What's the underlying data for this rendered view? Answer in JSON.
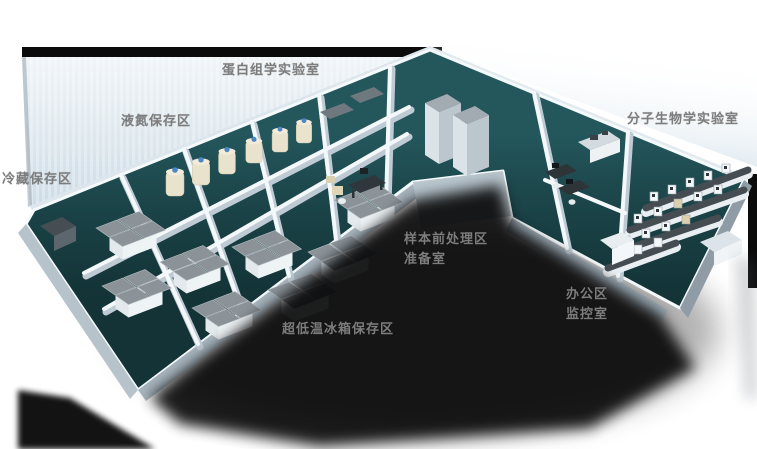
{
  "scene": {
    "kind": "3d-laboratory-floorplan-rendering",
    "colors": {
      "label_color": "#7d7d7d",
      "floor_teal": "#1d4e53",
      "cap_black": "#0b0b0b",
      "wall_white": "#f4f8fa",
      "backdrop_blue": "#d8e3eb",
      "tank_cream": "#e9e2cc",
      "tank_blue": "#4a86c8",
      "freezer_grey": "#8b9399",
      "shadow_black": "#000000"
    },
    "room_labels": [
      {
        "id": "cold-storage",
        "text": "冷藏保存区",
        "x": 2,
        "y": 168
      },
      {
        "id": "liquid-nitrogen",
        "text": "液氮保存区",
        "x": 121,
        "y": 110
      },
      {
        "id": "proteomics-lab",
        "text": "蛋白组学实验室",
        "x": 222,
        "y": 59
      },
      {
        "id": "molecular-biology-lab",
        "text": "分子生物学实验室",
        "x": 627,
        "y": 108
      },
      {
        "id": "sample-pretreatment",
        "text": "样本前处理区",
        "x": 404,
        "y": 228
      },
      {
        "id": "prep-room",
        "text": "准备室",
        "x": 404,
        "y": 248
      },
      {
        "id": "office-area",
        "text": "办公区",
        "x": 566,
        "y": 283
      },
      {
        "id": "monitoring-room",
        "text": "监控室",
        "x": 566,
        "y": 303
      },
      {
        "id": "ult-freezer-area",
        "text": "超低温冰箱保存区",
        "x": 282,
        "y": 318
      }
    ]
  }
}
